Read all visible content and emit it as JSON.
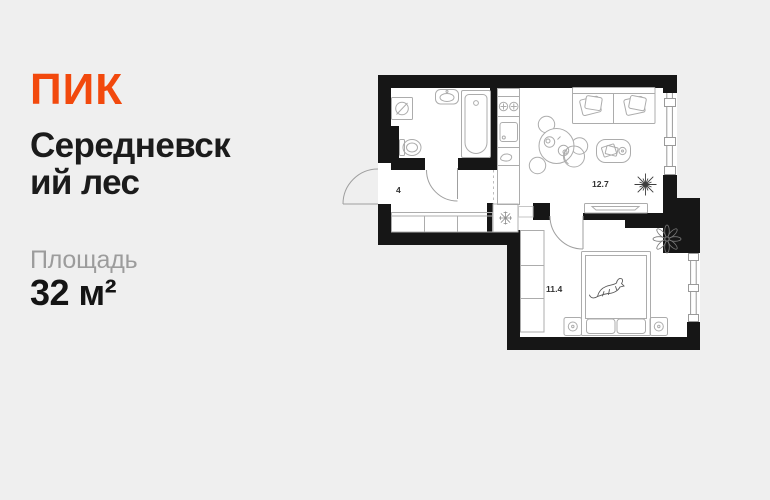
{
  "page": {
    "background_color": "#EFEFEF"
  },
  "brand": {
    "logo_text": "ПИК",
    "logo_color": "#F2490D"
  },
  "listing": {
    "title_full": "Середневский лес",
    "title_line1": "Середневск",
    "title_line2": "ий лес",
    "area_label": "Площадь",
    "area_value": "32 м²"
  },
  "floorplan": {
    "wall_color": "#161616",
    "floor_color": "#FFFFFF",
    "furniture_line_color": "#ACACAC",
    "rooms": [
      {
        "name": "hallway",
        "area": "4"
      },
      {
        "name": "kitchen-living-room",
        "area": "12.7"
      },
      {
        "name": "bedroom",
        "area": "11.4"
      }
    ],
    "feature_icons": [
      "washing-machine-icon",
      "wash-basin-icon",
      "toilet-icon",
      "bathtub-icon",
      "cooktop-icon",
      "kitchen-sink-icon",
      "kitchen-counter",
      "dining-table-icon",
      "stool-icon",
      "sofa-icon",
      "coffee-table-icon",
      "armchair-icon",
      "tv-stand-icon",
      "hallway-closet",
      "vent-shaft-icon",
      "wardrobe",
      "double-bed-icon",
      "cat-icon",
      "nightstand-icon",
      "plant-icon",
      "window",
      "door-swing"
    ]
  }
}
